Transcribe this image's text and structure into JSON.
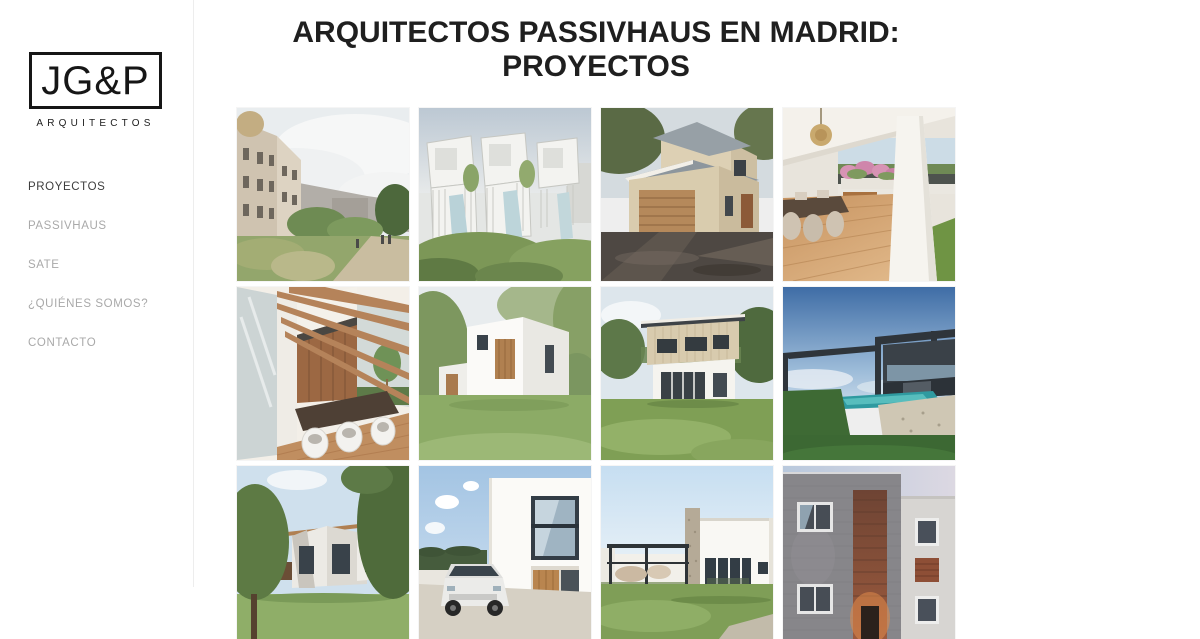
{
  "sidebar": {
    "logo": {
      "text": "JG&P",
      "subtext": "ARQUITECTOS"
    },
    "nav": [
      {
        "label": "PROYECTOS",
        "active": true
      },
      {
        "label": "PASSIVHAUS",
        "active": false
      },
      {
        "label": "SATE",
        "active": false
      },
      {
        "label": "¿QUIÉNES SOMOS?",
        "active": false
      },
      {
        "label": "CONTACTO",
        "active": false
      }
    ]
  },
  "main": {
    "title_line1": "ARQUITECTOS PASSIVHAUS EN MADRID:",
    "title_line2": "PROYECTOS",
    "projects": [
      {
        "name": "urban-park-street-render"
      },
      {
        "name": "white-modular-townhouses-pools"
      },
      {
        "name": "two-storey-house-wood-garage"
      },
      {
        "name": "covered-terrace-deck-pool"
      },
      {
        "name": "wood-pergola-dining-terrace"
      },
      {
        "name": "white-cube-house-garden"
      },
      {
        "name": "two-storey-passivhaus-lawn"
      },
      {
        "name": "dark-modern-villa-pool"
      },
      {
        "name": "angular-white-houses-trees"
      },
      {
        "name": "white-house-driveway-car"
      },
      {
        "name": "single-storey-house-pergola"
      },
      {
        "name": "stone-facade-house-wood-entrance"
      }
    ]
  },
  "colors": {
    "nav_active": "#3d3d3d",
    "nav_inactive": "#a9a9a9",
    "divider": "#ededed",
    "title_text": "#1f1f1f",
    "logo_ink": "#161616"
  }
}
